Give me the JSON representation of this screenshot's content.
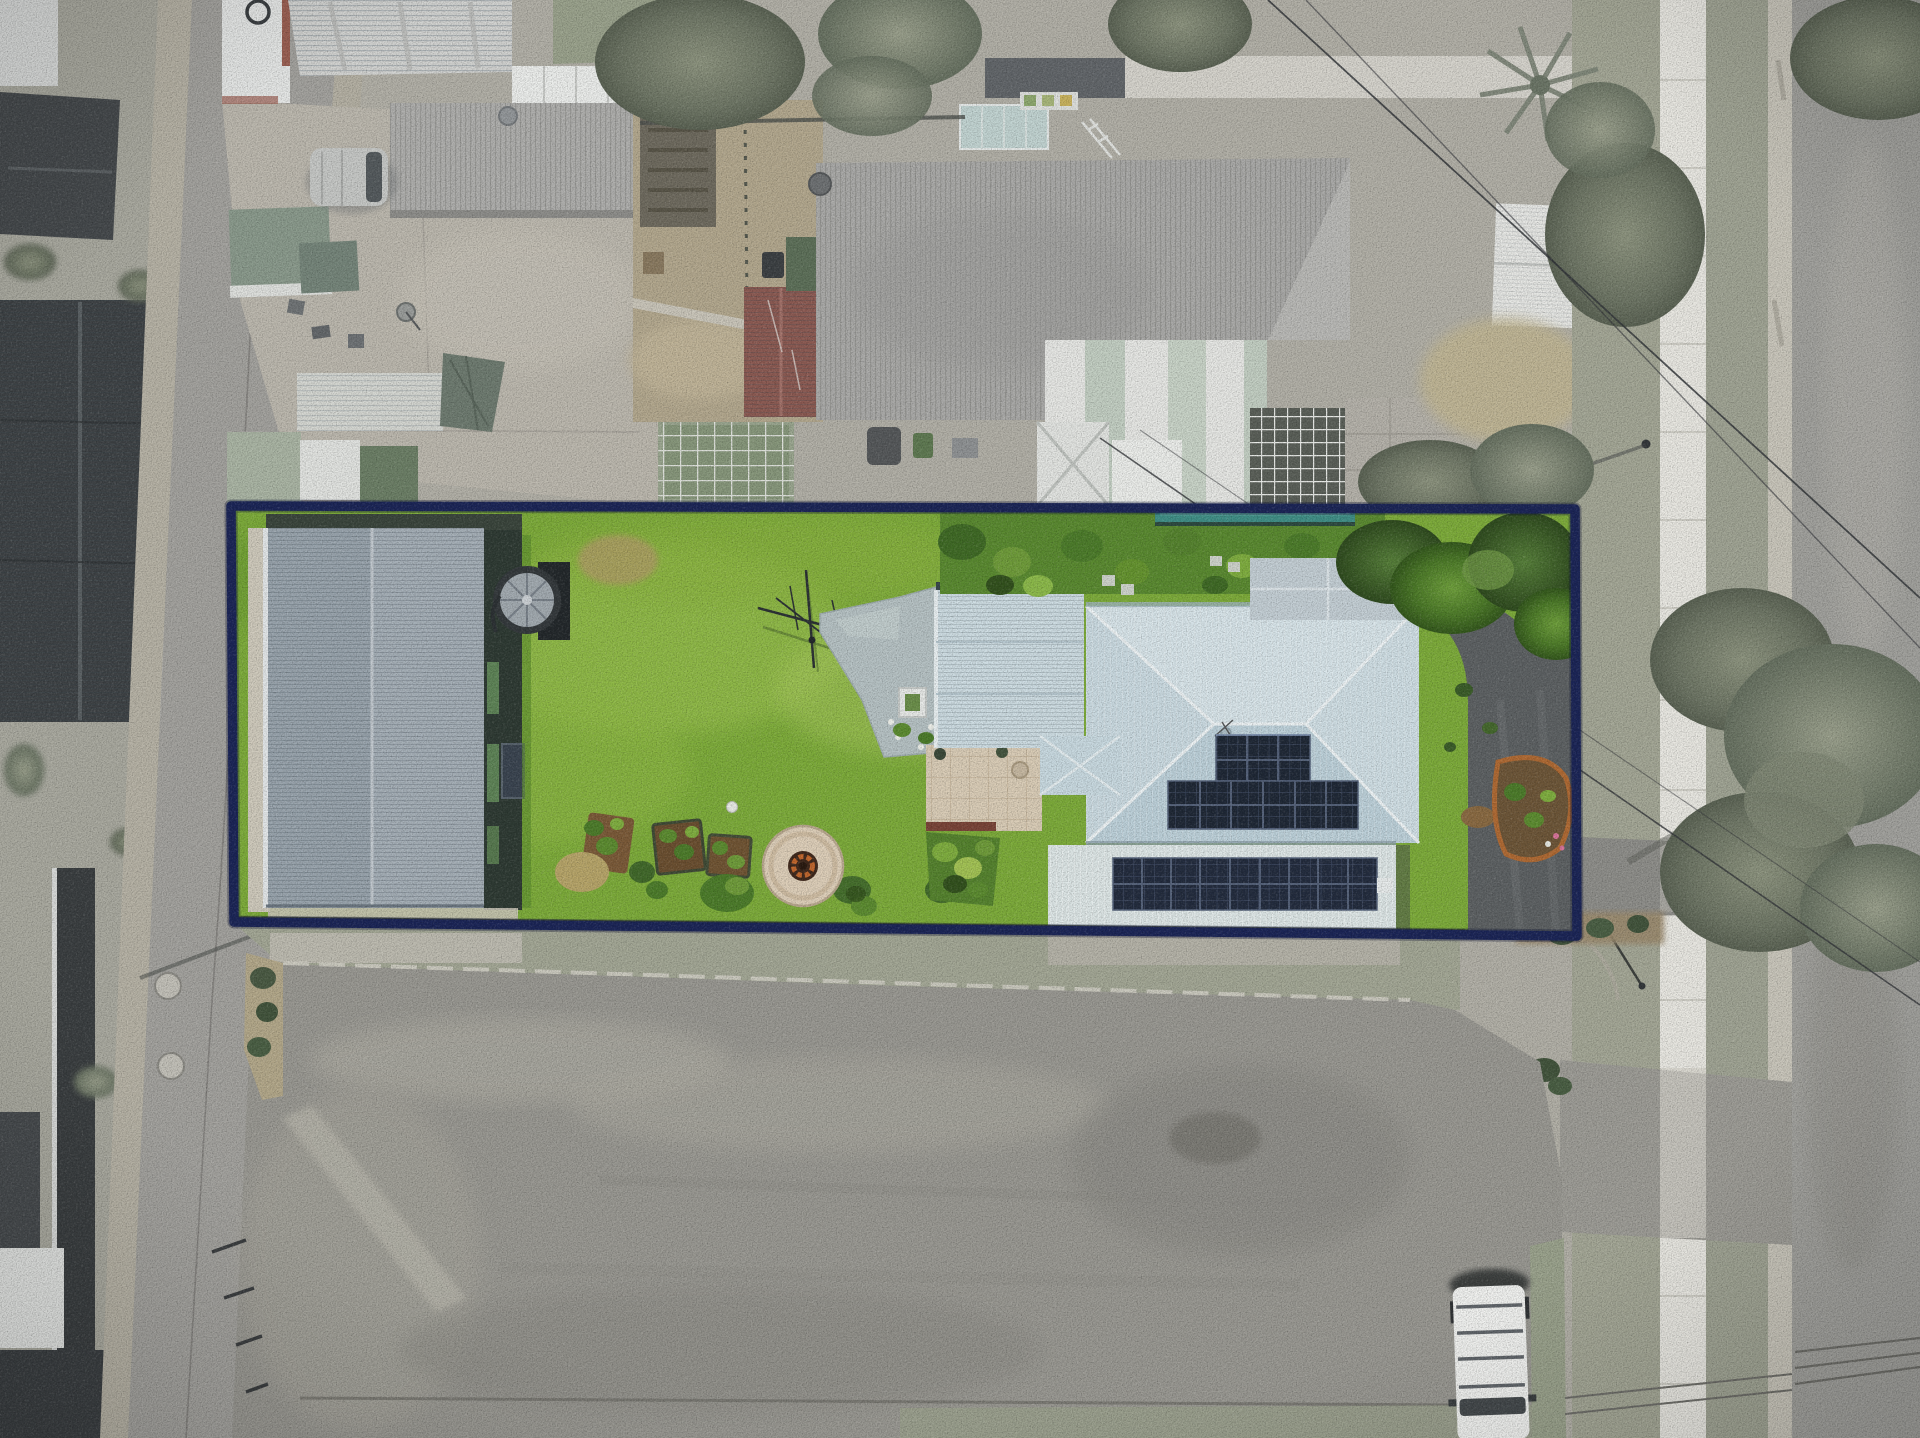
{
  "scene": {
    "type": "aerial-drone-photograph",
    "description": "Top-down drone photo of a long rectangular residential property outlined with a navy boundary overlay; interior shown in full colour, surroundings desaturated",
    "palette": {
      "boundary_navy": "#1b2557",
      "lawn_green": "#7dac3a",
      "lawn_light": "#9abf4e",
      "shed_roof_gray": "#9aa5ae",
      "house_roof_blue": "#c6d8e0",
      "garage_roof_white": "#dde6e6",
      "solar_panel_navy": "#1f2836",
      "pool_teal": "#3f8e86",
      "firepit_ring": "#decfb9",
      "firepit_fire": "#c1662c",
      "patio_cream": "#dacdb7",
      "path_bluegray": "#b6c2c4",
      "driveway_asphalt": "#5d6163",
      "outside_ground": "#b2b0a7",
      "outside_grass": "#a4a796",
      "road_gray": "#9b9a94",
      "footpath_concrete": "#e9e8e2",
      "neighbor_roof_gray": "#ababa9",
      "maroon_roof": "#8d5b53",
      "silver_roof": "#d3d4d2",
      "dark_roof": "#3e4245",
      "white_van": "#f1f2f0",
      "tree_desaturated": "#6e7665",
      "tree_green": "#4c7a28"
    },
    "elements": {
      "aerial-photo": "Aerial drone photograph of residential block and streets",
      "property-boundary-overlay": "Navy highlight outline around the advertised property",
      "property-interior": "Full-colour interior of the property parcel",
      "backyard-lawn": "Large bright green backyard lawn",
      "large-shed-roof": "Large gray corrugated shed roof at left of parcel",
      "water-tank": "Round rainwater tank beside shed",
      "fire-pit": "Circular paved fire pit area on lawn",
      "tv-antenna": "TV antenna mast lying over lawn",
      "garden-beds": "Row of small garden beds along rear fence",
      "garden-path": "Pale blue-gray concrete path to house",
      "paved-patio": "Cream paver patio beside house",
      "main-house-roof": "Pale blue hip roof of main house",
      "front-wing-roof": "Silvery front wing roof section",
      "garage-roof": "Lower white garage / skillion roof",
      "solar-array-upper": "Upper rooftop solar panel banks",
      "solar-array-lower": "Long lower solar panel array",
      "swimming-pool-strip": "Narrow teal pool strip along rear boundary",
      "property-driveway": "Dark asphalt driveway along right side of house",
      "left-road": "Desaturated street running down the left side",
      "bottom-road": "Wide desaturated road area across the bottom",
      "right-road": "Street corridor on the right with footpath",
      "concrete-footpath": "White concrete footpath strip",
      "white-van": "White van parked at bottom right, partly out of frame",
      "silver-van-neighbor": "Silver van in neighbouring driveway at top left",
      "neighbor-house-roof": "Large gray corrugated neighbour roof above boundary",
      "maroon-roof-shed": "Maroon roofed outbuilding in neighbour yard",
      "greenhouse": "White framed greenhouse in neighbour yard",
      "street-tree": "Large street tree overhanging right road",
      "power-lines": "Thin power lines crossing the right corridor"
    }
  }
}
